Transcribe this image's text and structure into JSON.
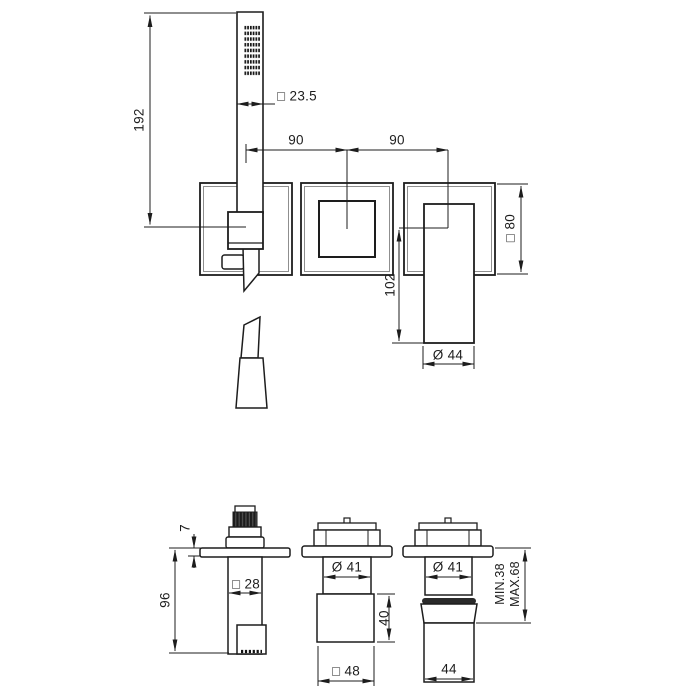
{
  "page": {
    "background": "#ffffff",
    "line_color": "#1d1d1d"
  },
  "drawing": {
    "front_view": {
      "labels": {
        "shower_length": "192",
        "handshower_section": "□ 23.5",
        "spacing_left": "90",
        "spacing_right": "90",
        "plate_size": "□ 80",
        "lever_length": "102",
        "lever_diameter": "Ø 44"
      }
    },
    "bottom_view": {
      "labels": {
        "flange_thickness": "7",
        "holder_projection": "96",
        "holder_section": "□ 28",
        "neck_diameter_mid": "Ø 41",
        "body_height_mid": "40",
        "body_section_mid": "□ 48",
        "neck_diameter_right": "Ø 41",
        "body_diameter_right": "44",
        "depth_min": "MIN.38",
        "depth_max": "MAX.68"
      }
    }
  }
}
